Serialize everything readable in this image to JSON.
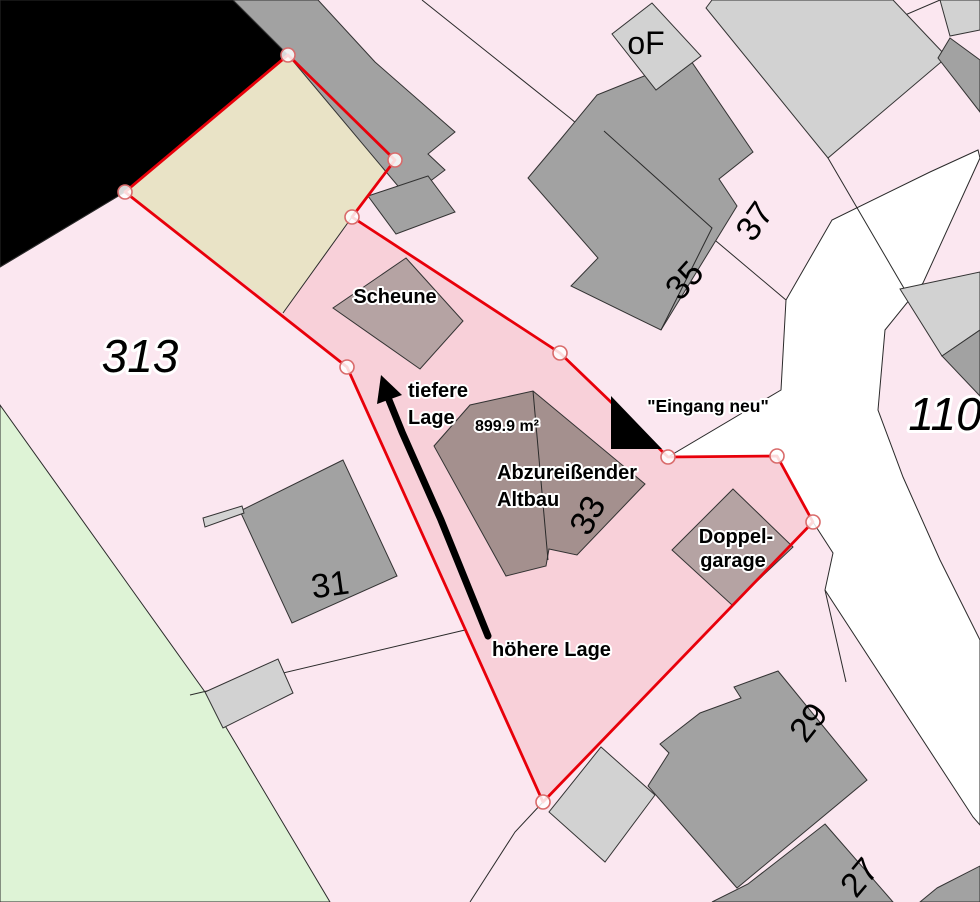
{
  "map": {
    "colors": {
      "background_pink": "#fbe7f0",
      "parcel_green": "#def3d6",
      "selected_parcel_pink": "#f8d0d9",
      "selected_subarea_yellow": "#e9e3c6",
      "road_white": "#ffffff",
      "boundary_red": "#e8000a",
      "vertex_fill": "#ffffff",
      "vertex_ring": "#d96a6a",
      "building_gray": "#a2a2a2",
      "building_light_gray": "#d2d2d2",
      "building_brown": "#b5a3a3",
      "building_brown_dark": "#a4908e",
      "annotation_black": "#000000",
      "area_text_red": "#e30613"
    },
    "parcel_numbers": {
      "left": "313",
      "right": "110"
    },
    "house_numbers": {
      "oF": "oF",
      "n27": "27",
      "n29": "29",
      "n31": "31",
      "n33": "33",
      "n35": "35",
      "n37": "37"
    },
    "building_labels": {
      "scheune": "Scheune",
      "altbau_line1": "Abzureißender",
      "altbau_line2": "Altbau",
      "garage_line1": "Doppel-",
      "garage_line2": "garage"
    },
    "annotations": {
      "area_value": "899.9 m²",
      "entrance": "\"Eingang neu\"",
      "lower_line1": "tiefere",
      "lower_line2": "Lage",
      "higher": "höhere Lage"
    }
  }
}
